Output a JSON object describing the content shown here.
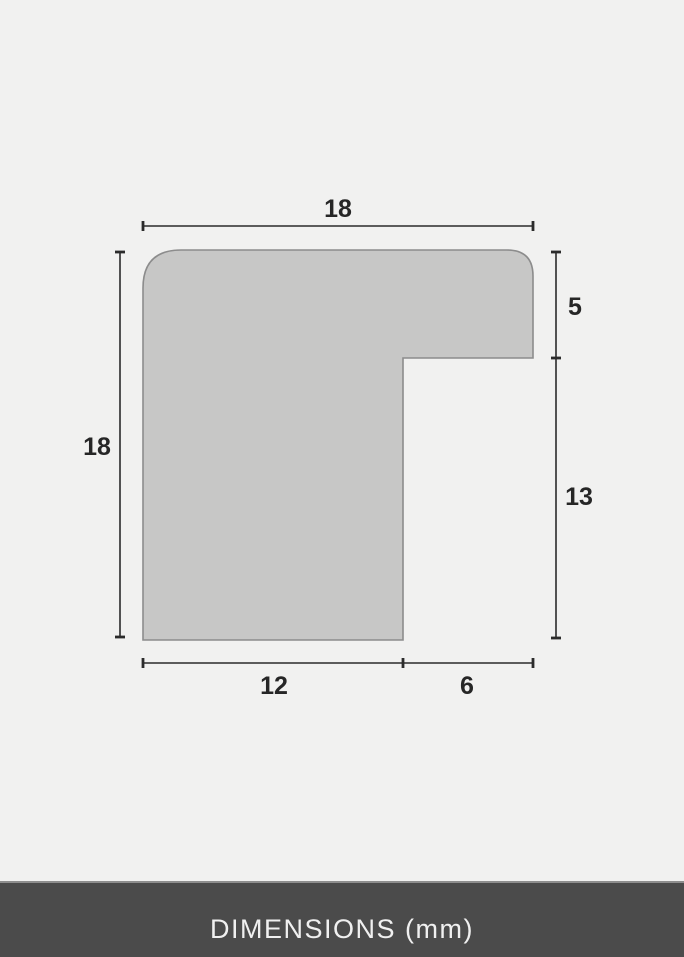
{
  "diagram": {
    "dims": {
      "top_width": "18",
      "left_height": "18",
      "right_upper": "5",
      "right_lower": "13",
      "bottom_left": "12",
      "bottom_right": "6"
    },
    "colors": {
      "background": "#f1f1f0",
      "shape_fill": "#c7c7c6",
      "shape_stroke": "#8c8c8c",
      "dim_line": "#2b2b2b",
      "label_text": "#262626",
      "footer_background": "#4b4b4b",
      "footer_text": "#f0f0f0"
    }
  },
  "footer": {
    "label": "DIMENSIONS (mm)"
  }
}
